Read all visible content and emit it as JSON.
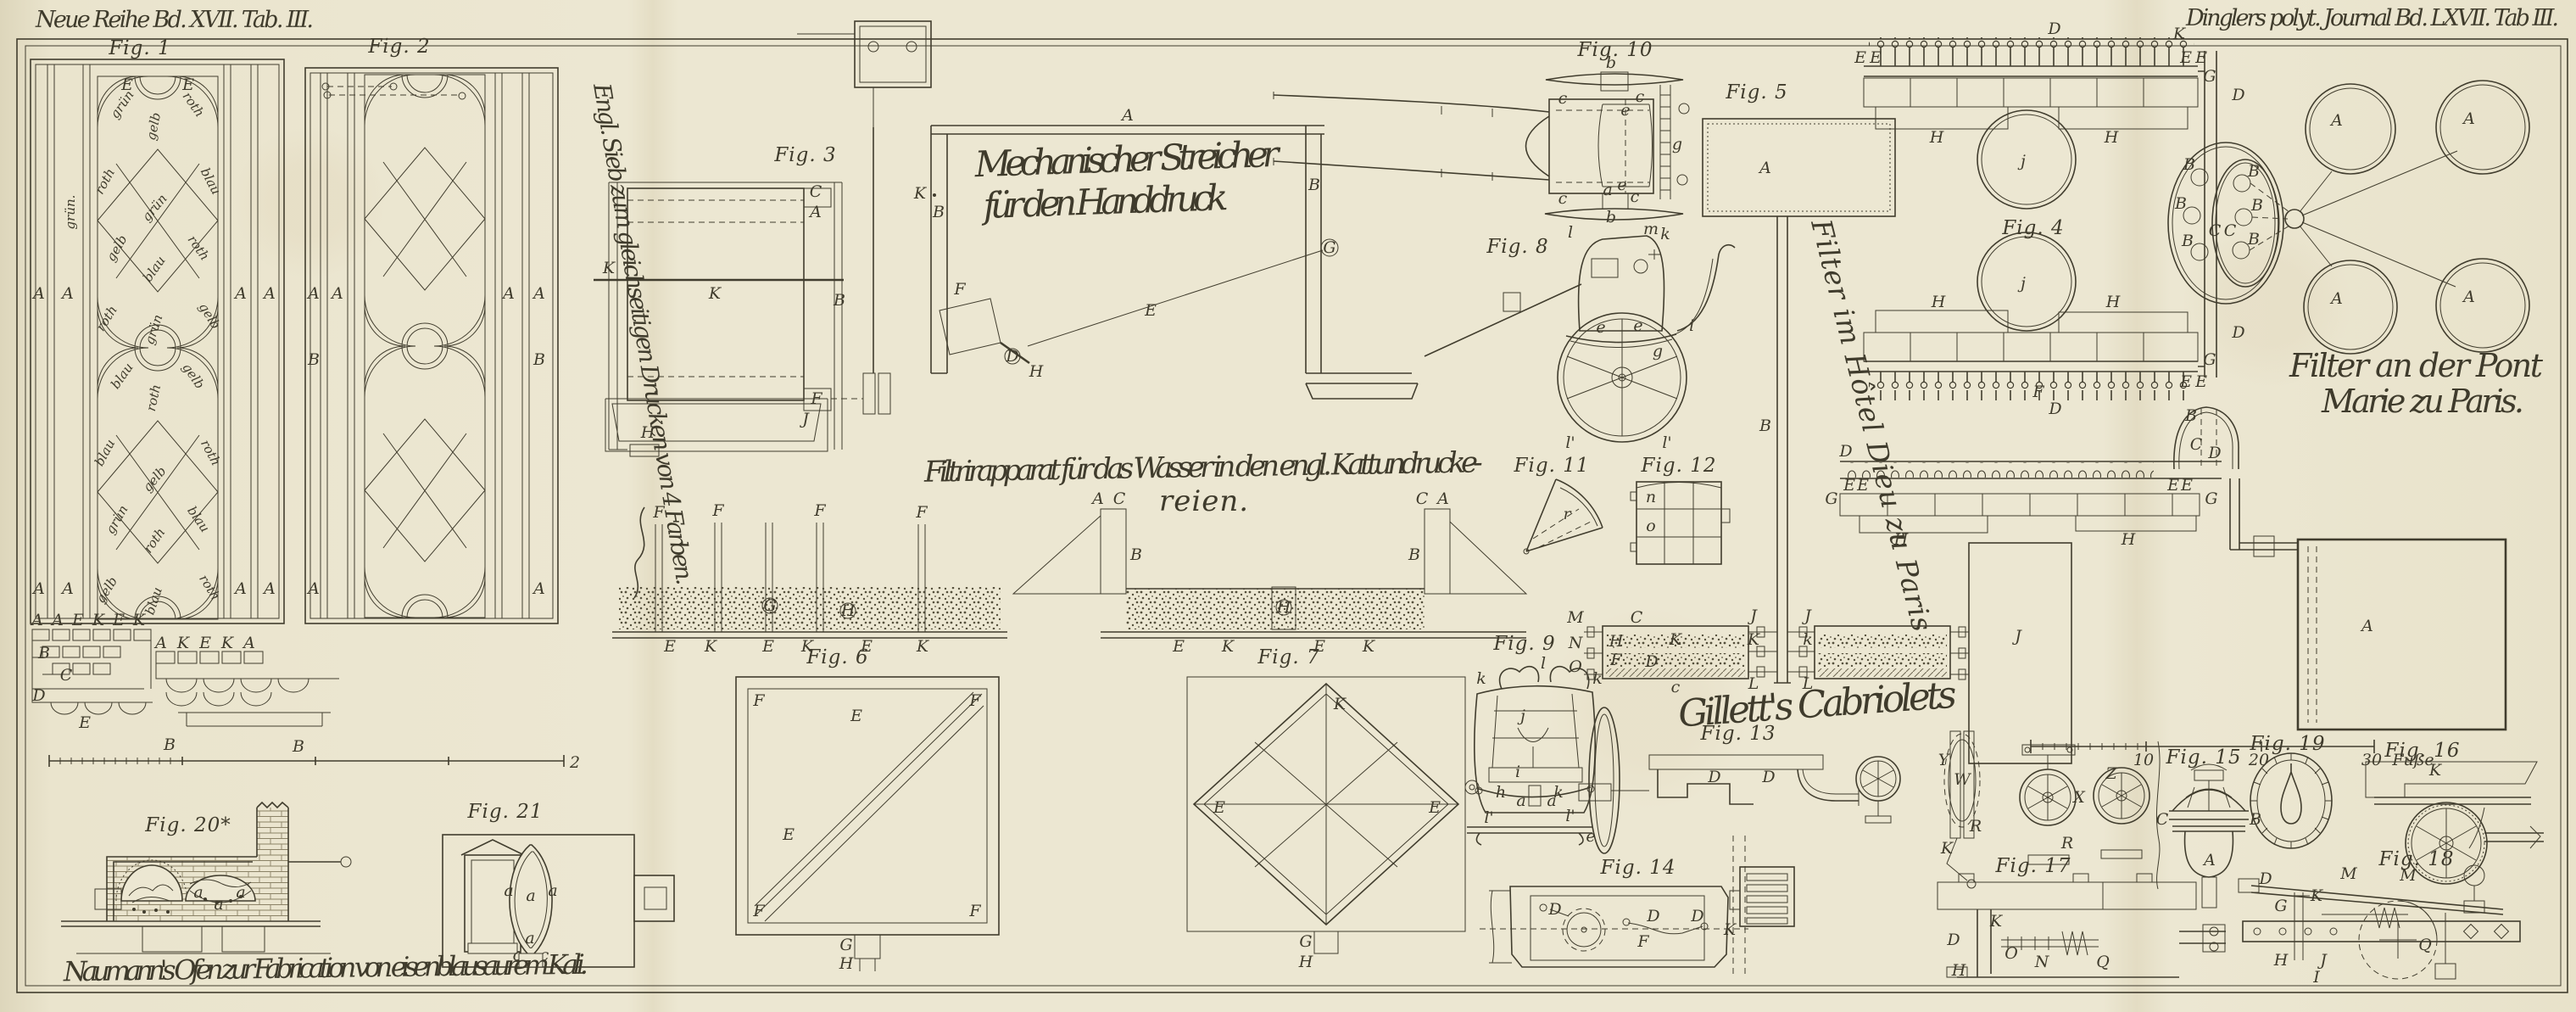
{
  "plate": {
    "title_left": "Neue Reihe Bd. XVII. Tab. III.",
    "title_right": "Dinglers polyt. Journal Bd. LXVII. Tab III.",
    "paper_color": "#eae4cd",
    "ink_color": "#3f3b2c"
  },
  "captions": {
    "sieve": "Engl. Sieb zum gleichseitigen Drucken von 4 Farben.",
    "streicher1": "Mechanischer Streicher",
    "streicher2": "für den Handdruck",
    "filter1": "Filtrirapparat für das Wasser in den engl. Kattundrucke-",
    "filter2": "reien.",
    "hotel_dieu": "Filter im Hôtel Dieu zu Paris",
    "pont1": "Filter an der Pont",
    "pont2": "Marie zu Paris.",
    "gillett": "Gillett's Cabriolets",
    "naumann": "Naumann's Ofen zur Fabrication von eisenblausaurem Kali.",
    "scale_unit": "Fuße",
    "s10": "10",
    "s20": "20",
    "s30": "30",
    "s2": "2"
  },
  "figs": {
    "f1": "Fig. 1",
    "f2": "Fig. 2",
    "f3": "Fig. 3",
    "f4": "Fig. 4",
    "f5": "Fig. 5",
    "f6": "Fig. 6",
    "f7": "Fig. 7",
    "f8": "Fig. 8",
    "f9": "Fig. 9",
    "f10": "Fig. 10",
    "f11": "Fig. 11",
    "f12": "Fig. 12",
    "f13": "Fig. 13",
    "f14": "Fig. 14",
    "f15": "Fig. 15",
    "f16": "Fig. 16",
    "f17": "Fig. 17",
    "f18": "Fig. 18",
    "f19": "Fig. 19",
    "f20": "Fig. 20*",
    "f21": "Fig. 21"
  },
  "words": {
    "a": [
      "grün",
      "roth",
      "gelb",
      "roth",
      "blau",
      "grün",
      "gelb",
      "roth",
      "blau",
      "roth",
      "grün",
      "gelb"
    ],
    "b": [
      "blau",
      "gelb",
      "roth",
      "blau",
      "roth",
      "gelb",
      "grün",
      "blau",
      "roth",
      "gelb",
      "blau",
      "roth"
    ],
    "v": "grün."
  },
  "letters": {
    "l1t": [
      "E",
      "E"
    ],
    "l1a": [
      "A",
      "A",
      "A",
      "A",
      "A",
      "A",
      "A",
      "A"
    ],
    "l1x": [
      "A",
      "A",
      "E",
      "K",
      "E",
      "K",
      "B",
      "C",
      "D",
      "E"
    ],
    "l2": [
      "A",
      "A",
      "A",
      "A",
      "B",
      "B",
      "A",
      "A"
    ],
    "l2x": [
      "A",
      "K",
      "E",
      "K",
      "A",
      "B",
      "B"
    ],
    "l3": [
      "C",
      "A",
      "K",
      "K",
      "B",
      "F",
      "J",
      "H"
    ],
    "lst": [
      "A",
      "K",
      "B",
      "B",
      "G",
      "E",
      "F",
      "D",
      "H"
    ],
    "lfl": [
      "F",
      "F",
      "F",
      "F",
      "G",
      "H",
      "E",
      "K",
      "E",
      "K",
      "E",
      "K"
    ],
    "lfr": [
      "A",
      "C",
      "B",
      "B",
      "H",
      "C",
      "A",
      "E",
      "K",
      "E",
      "K"
    ],
    "l6": [
      "F",
      "F",
      "F",
      "F",
      "E",
      "E",
      "G",
      "H"
    ],
    "l7": [
      "K",
      "E",
      "E",
      "G",
      "H"
    ],
    "l10": [
      "b",
      "c",
      "c",
      "e",
      "g",
      "e",
      "c",
      "c",
      "a",
      "b"
    ],
    "l8": [
      "l",
      "m",
      "k",
      "e",
      "e",
      "i",
      "g",
      "l'",
      "l'"
    ],
    "l5": [
      "A",
      "B"
    ],
    "lhd": [
      "C",
      "H",
      "F",
      "D",
      "K",
      "c",
      "M",
      "N",
      "O",
      "J",
      "J",
      "K",
      "k",
      "L",
      "L"
    ],
    "l4": [
      "D",
      "K",
      "E",
      "E",
      "E",
      "E",
      "G",
      "D",
      "H",
      "H",
      "j",
      "j",
      "H",
      "H",
      "G",
      "E",
      "E",
      "F",
      "D",
      "D"
    ],
    "lov": [
      "B",
      "B",
      "B",
      "B",
      "B",
      "B",
      "C",
      "C"
    ],
    "lpc": [
      "A",
      "A",
      "A",
      "A"
    ],
    "lsp": [
      "D",
      "D",
      "E",
      "E",
      "E",
      "E",
      "G",
      "G",
      "H",
      "H",
      "J",
      "A",
      "B",
      "C"
    ],
    "l9": [
      "k",
      "k",
      "l",
      "j",
      "i",
      "h",
      "k",
      "a",
      "a",
      "l'",
      "l'",
      "e"
    ],
    "l11": [
      "r"
    ],
    "l12": [
      "n",
      "o"
    ],
    "l13": [
      "D",
      "D"
    ],
    "lcl": [
      "Y",
      "W",
      "R",
      "K",
      "X",
      "R",
      "Z"
    ],
    "l14": [
      "D",
      "D",
      "D",
      "F",
      "K"
    ],
    "l15": [
      "C",
      "B",
      "A"
    ],
    "l16": [
      "K",
      "M"
    ],
    "l17": [
      "K",
      "N",
      "O",
      "Q",
      "D",
      "H"
    ],
    "l18": [
      "D",
      "M",
      "G",
      "K",
      "H",
      "J",
      "I",
      "Q"
    ],
    "l20": [
      "a",
      "a",
      "a"
    ],
    "l21": [
      "a",
      "a",
      "a",
      "a",
      "c",
      "c"
    ]
  }
}
